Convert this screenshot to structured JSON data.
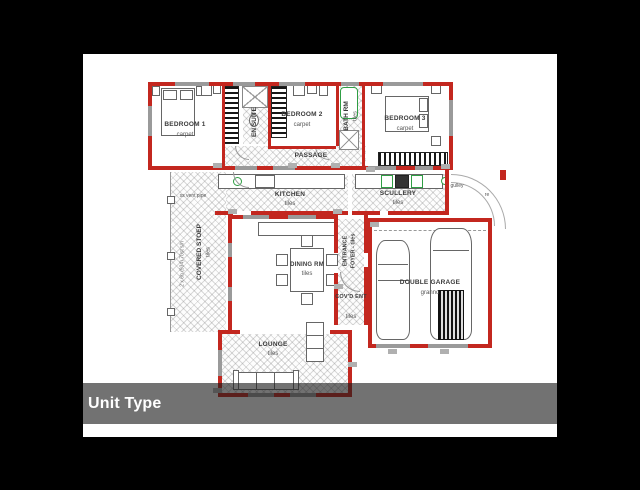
{
  "caption": {
    "label": "Unit Type"
  },
  "plan": {
    "rooms": {
      "bedroom1": {
        "name": "BEDROOM 1",
        "floor": "carpet"
      },
      "ensuite": {
        "name": "EN SUITE"
      },
      "bedroom2": {
        "name": "BEDROOM 2",
        "floor": "carpet"
      },
      "bathrm": {
        "name": "BATH RM",
        "floor": "tiles"
      },
      "bedroom3": {
        "name": "BEDROOM 3",
        "floor": "carpet"
      },
      "passage": {
        "name": "PASSAGE"
      },
      "kitchen": {
        "name": "KITCHEN",
        "floor": "tiles"
      },
      "scullery": {
        "name": "SCULLERY",
        "floor": "tiles"
      },
      "covered_stoep": {
        "name": "COVERED STOEP",
        "floor": "tiles"
      },
      "dining": {
        "name": "DINING RM",
        "floor": "tiles"
      },
      "entrance_foyer": {
        "line1": "ENTRANCE",
        "line2": "FOYER - tiles"
      },
      "covd_ent": {
        "name": "COV'D ENT",
        "floor": "tiles"
      },
      "garage": {
        "name": "DOUBLE GARAGE",
        "floor": "granno"
      },
      "lounge": {
        "name": "LOUNGE",
        "floor": "tiles"
      }
    },
    "annotations": {
      "vent_pipe": "ss vent pipe",
      "gulley": "gulley",
      "re": "re",
      "stoep_dim": "2 x 6b (934) 70st s/h"
    },
    "colors": {
      "wall_red": "#c3271f",
      "window_gray": "#9a9a9a",
      "fixture_green": "#2f9e44",
      "caption_bg": "rgba(28,28,28,0.62)",
      "page_bg": "#000000"
    }
  }
}
